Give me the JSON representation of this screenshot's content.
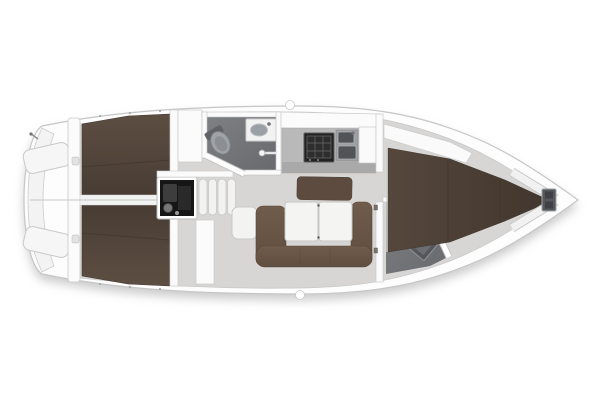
{
  "meta": {
    "title": "Sailing yacht interior floor plan",
    "view": "top-down floor plan",
    "orientation": {
      "bow": "right",
      "stern": "left"
    }
  },
  "vessel": {
    "rooms": [
      {
        "id": "swim-platform",
        "label": "Transom swim platform"
      },
      {
        "id": "helm-seats",
        "label": "Cockpit helm seats"
      },
      {
        "id": "aft-cabin-port",
        "label": "Aft double cabin (port)"
      },
      {
        "id": "aft-cabin-starboard",
        "label": "Aft double cabin (starboard)"
      },
      {
        "id": "engine-compartment",
        "label": "Engine compartment"
      },
      {
        "id": "companionway",
        "label": "Companionway steps"
      },
      {
        "id": "aft-head",
        "label": "Aft head with shower"
      },
      {
        "id": "galley",
        "label": "Galley with stove and double sink"
      },
      {
        "id": "salon",
        "label": "Salon with U-sofa and folding table"
      },
      {
        "id": "nav-seat",
        "label": "Navigator seat"
      },
      {
        "id": "forward-head",
        "label": "Forward head"
      },
      {
        "id": "forward-cabin",
        "label": "Forward V-berth cabin"
      },
      {
        "id": "anchor-locker",
        "label": "Anchor locker"
      }
    ],
    "furniture": [
      "double-berth",
      "double-berth",
      "v-berth",
      "u-sofa",
      "folding-table",
      "toilet",
      "toilet",
      "washbasin",
      "washbasin",
      "shower-head",
      "stove",
      "double-sink",
      "engine",
      "steps",
      "helm-seat",
      "helm-seat"
    ]
  },
  "colors": {
    "background": "#ffffff",
    "hull": "#fdfdfd",
    "hull_outline": "#c6c6c6",
    "deck_white": "#f5f5f4",
    "floor": "#d7d6d4",
    "wet_floor": "#75777b",
    "bed_brown_dark": "#52443b",
    "bed_seam": "#42382f",
    "sofa_brown": "#6b5747",
    "backrest_brown": "#5d4b3f",
    "table_white": "#f4f4f3",
    "wall_white": "#fbfbfb",
    "wall_outline": "#c4c4c4",
    "counter_gray": "#b9b9ba",
    "stove_black": "#222222",
    "sink_steel": "#9e9fa0",
    "basin_dark": "#515356",
    "engine_black": "#161616",
    "fixture_gray": "#9aa0a5",
    "shadow": "#b5b5b5"
  }
}
